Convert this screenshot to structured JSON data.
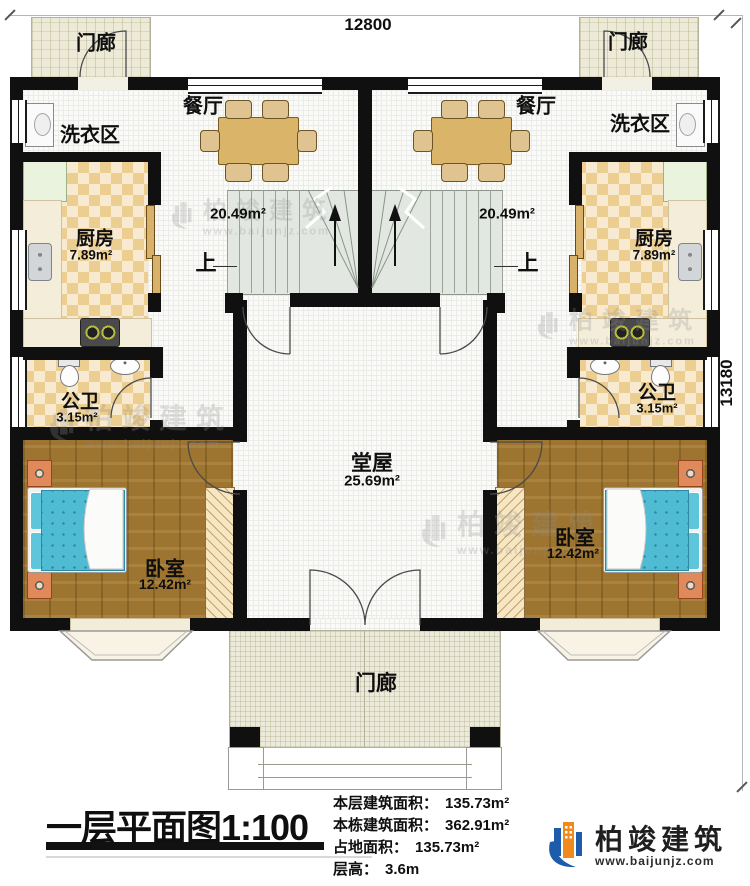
{
  "dimensions": {
    "top": "12800",
    "right": "13180"
  },
  "rooms": {
    "porch": "门廊",
    "dining": "餐厅",
    "laundry": "洗衣区",
    "kitchen": "厨房",
    "kitchen_area": "7.89m²",
    "living_area": "20.49m²",
    "up": "上",
    "bathroom": "公卫",
    "bathroom_area": "3.15m²",
    "hall": "堂屋",
    "hall_area": "25.69m²",
    "bedroom": "卧室",
    "bedroom_area": "12.42m²"
  },
  "title_block": {
    "title": "一层平面图1:100",
    "stats": [
      {
        "label": "本层建筑面积：",
        "value": "135.73m²"
      },
      {
        "label": "本栋建筑面积：",
        "value": "362.91m²"
      },
      {
        "label": "占地面积：",
        "value": "135.73m²"
      },
      {
        "label": "层高：",
        "value": "3.6m"
      }
    ]
  },
  "logo": {
    "name": "柏竣建筑",
    "url": "www.baijunjz.com"
  },
  "watermark": {
    "name": "柏竣建筑",
    "url": "www.baijunjz.com"
  },
  "colors": {
    "wall": "#101010",
    "checker_dark": "#ecce90",
    "checker_light": "#f8ead0",
    "wood_floor": "#9d7430",
    "stair": "#e2e8e1",
    "bed": "#4fbcd4",
    "porch": "#edebd8",
    "logo_blue": "#1d5cab",
    "logo_orange": "#f08a1d"
  }
}
